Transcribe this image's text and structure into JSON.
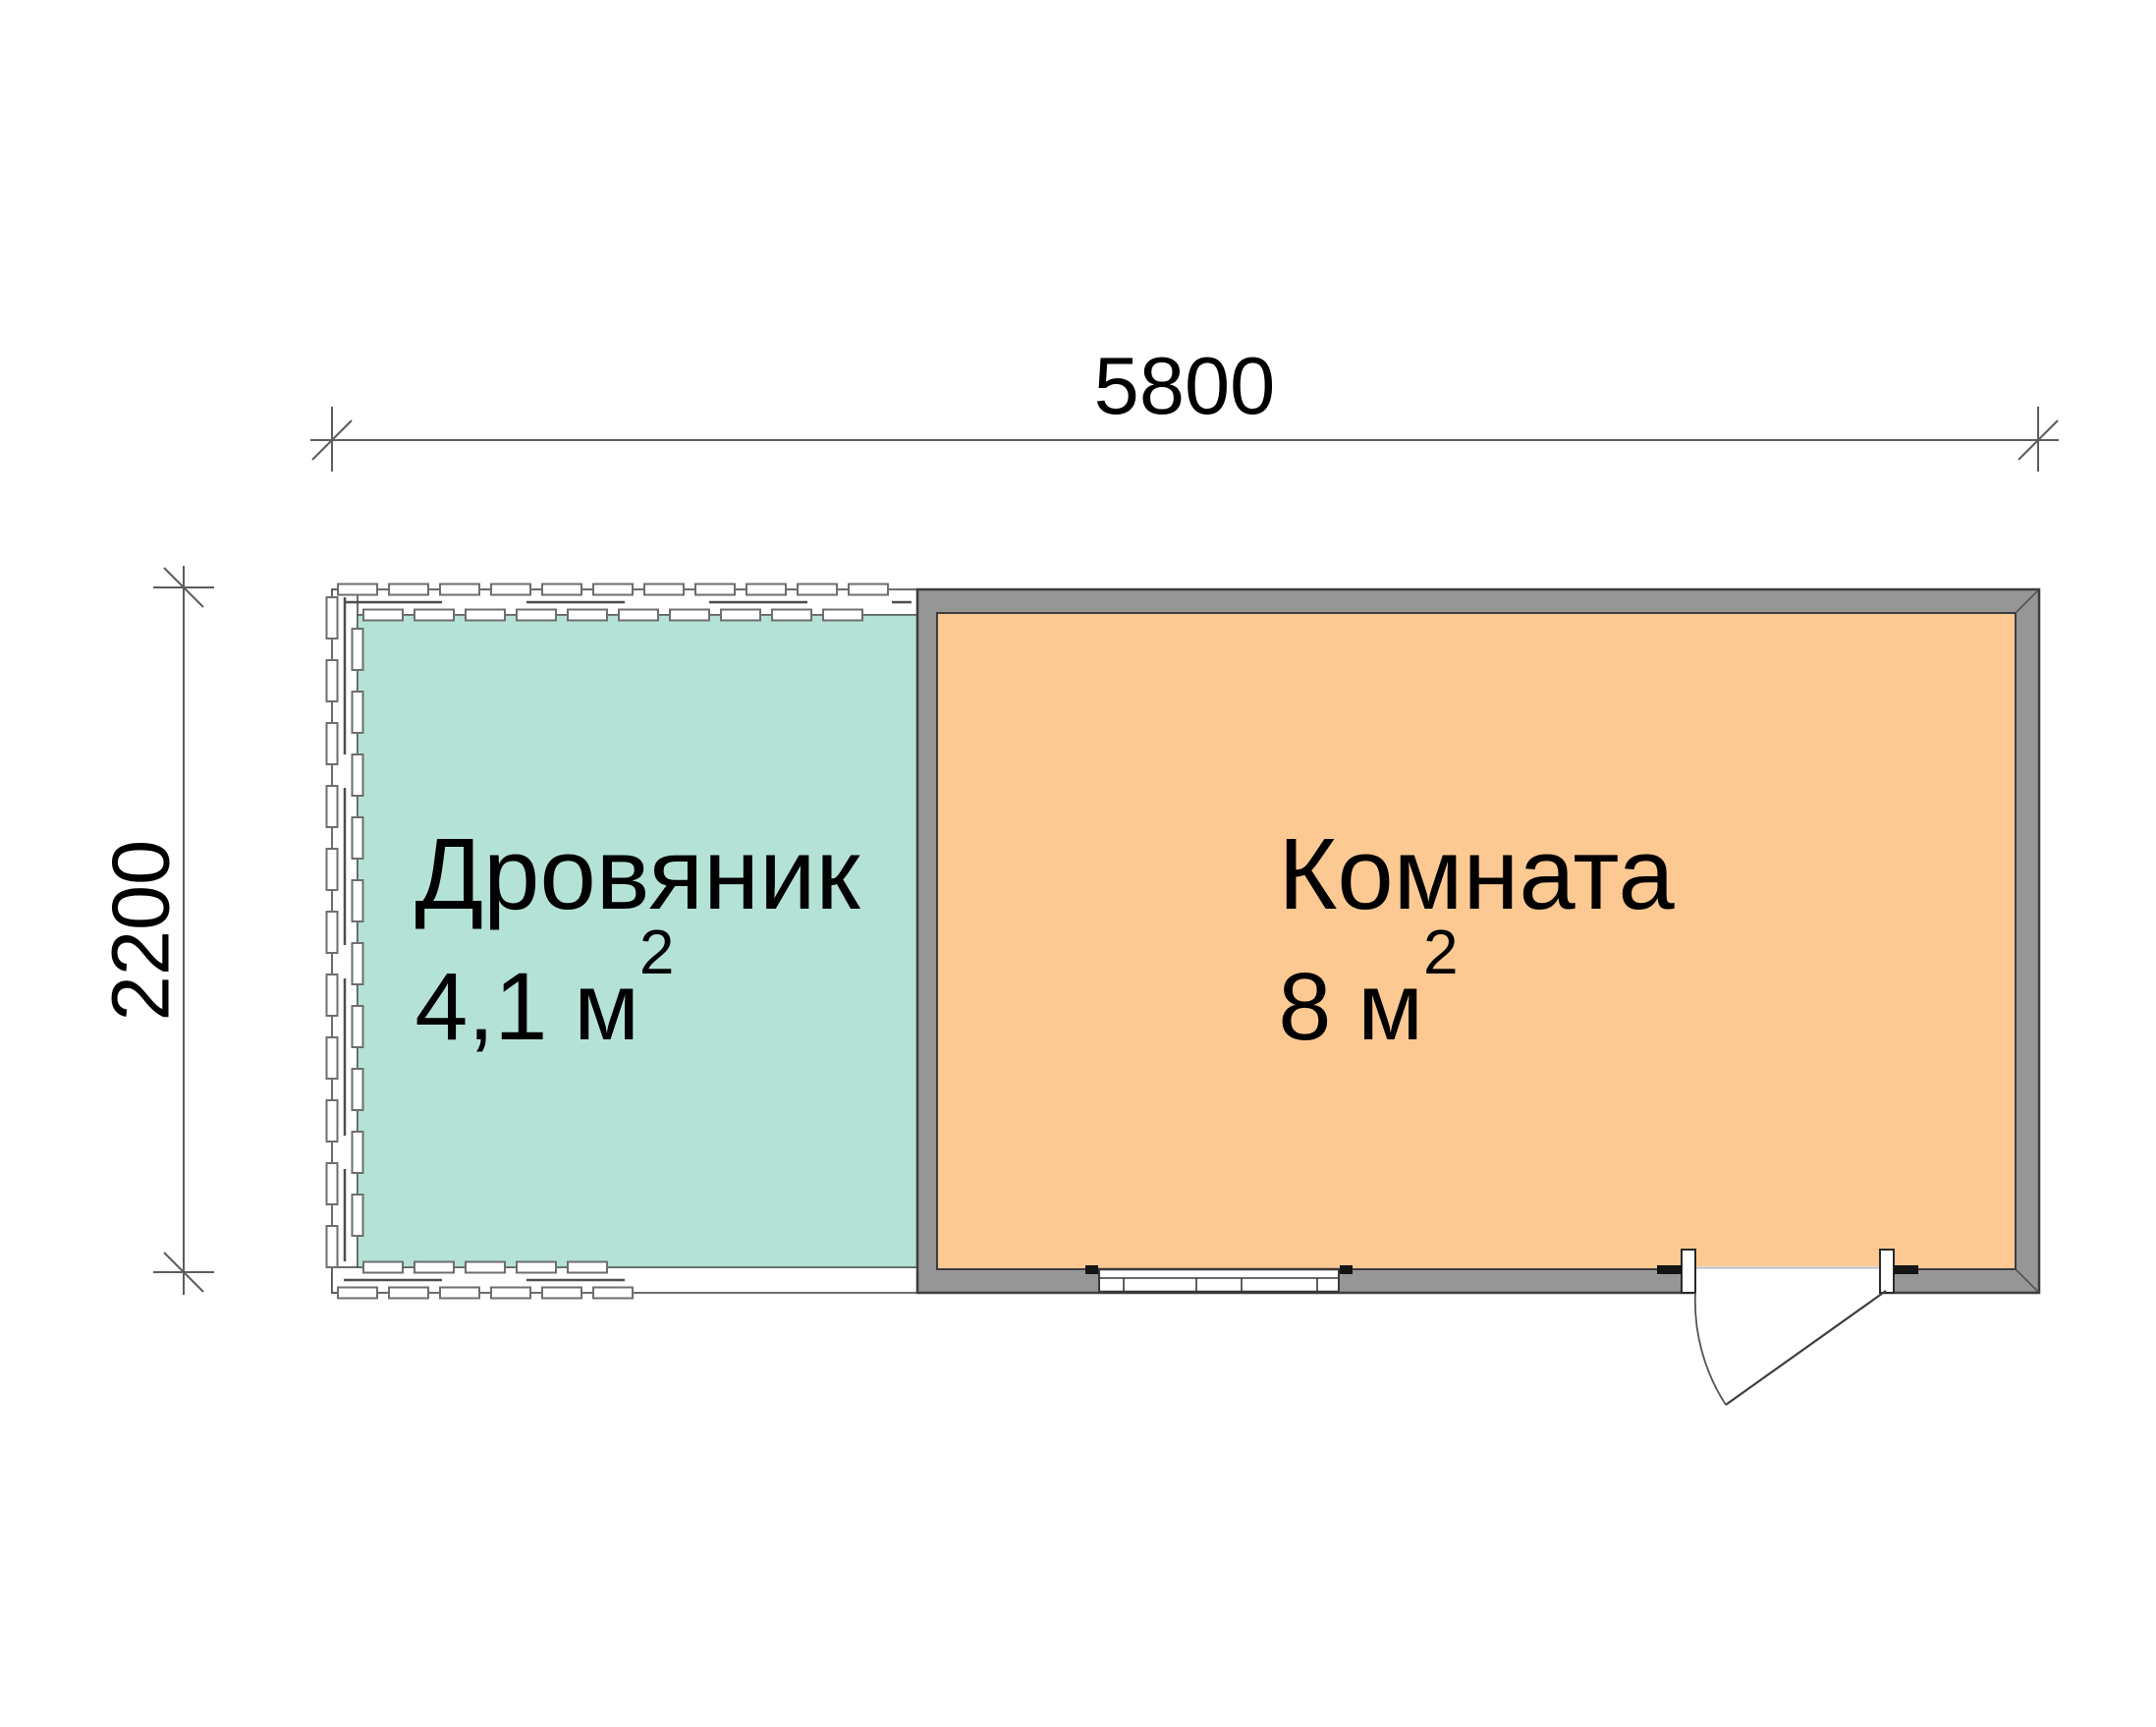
{
  "dimensions": {
    "top": {
      "label": "5800"
    },
    "left": {
      "label": "2200"
    }
  },
  "rooms": [
    {
      "name": "Дровяник",
      "area_value": "4,1 м",
      "area_sup": "2",
      "fill": "#b5e2d7"
    },
    {
      "name": "Комната",
      "area_value": "8 м",
      "area_sup": "2",
      "fill": "#fdc993"
    }
  ],
  "walls": {
    "gray_fill": "#969696",
    "outline": "#3d3d3d",
    "plank_fill": "#ffffff",
    "plank_stroke": "#6e6e6e"
  },
  "lines": {
    "dimension_color": "#5c5c5c"
  }
}
